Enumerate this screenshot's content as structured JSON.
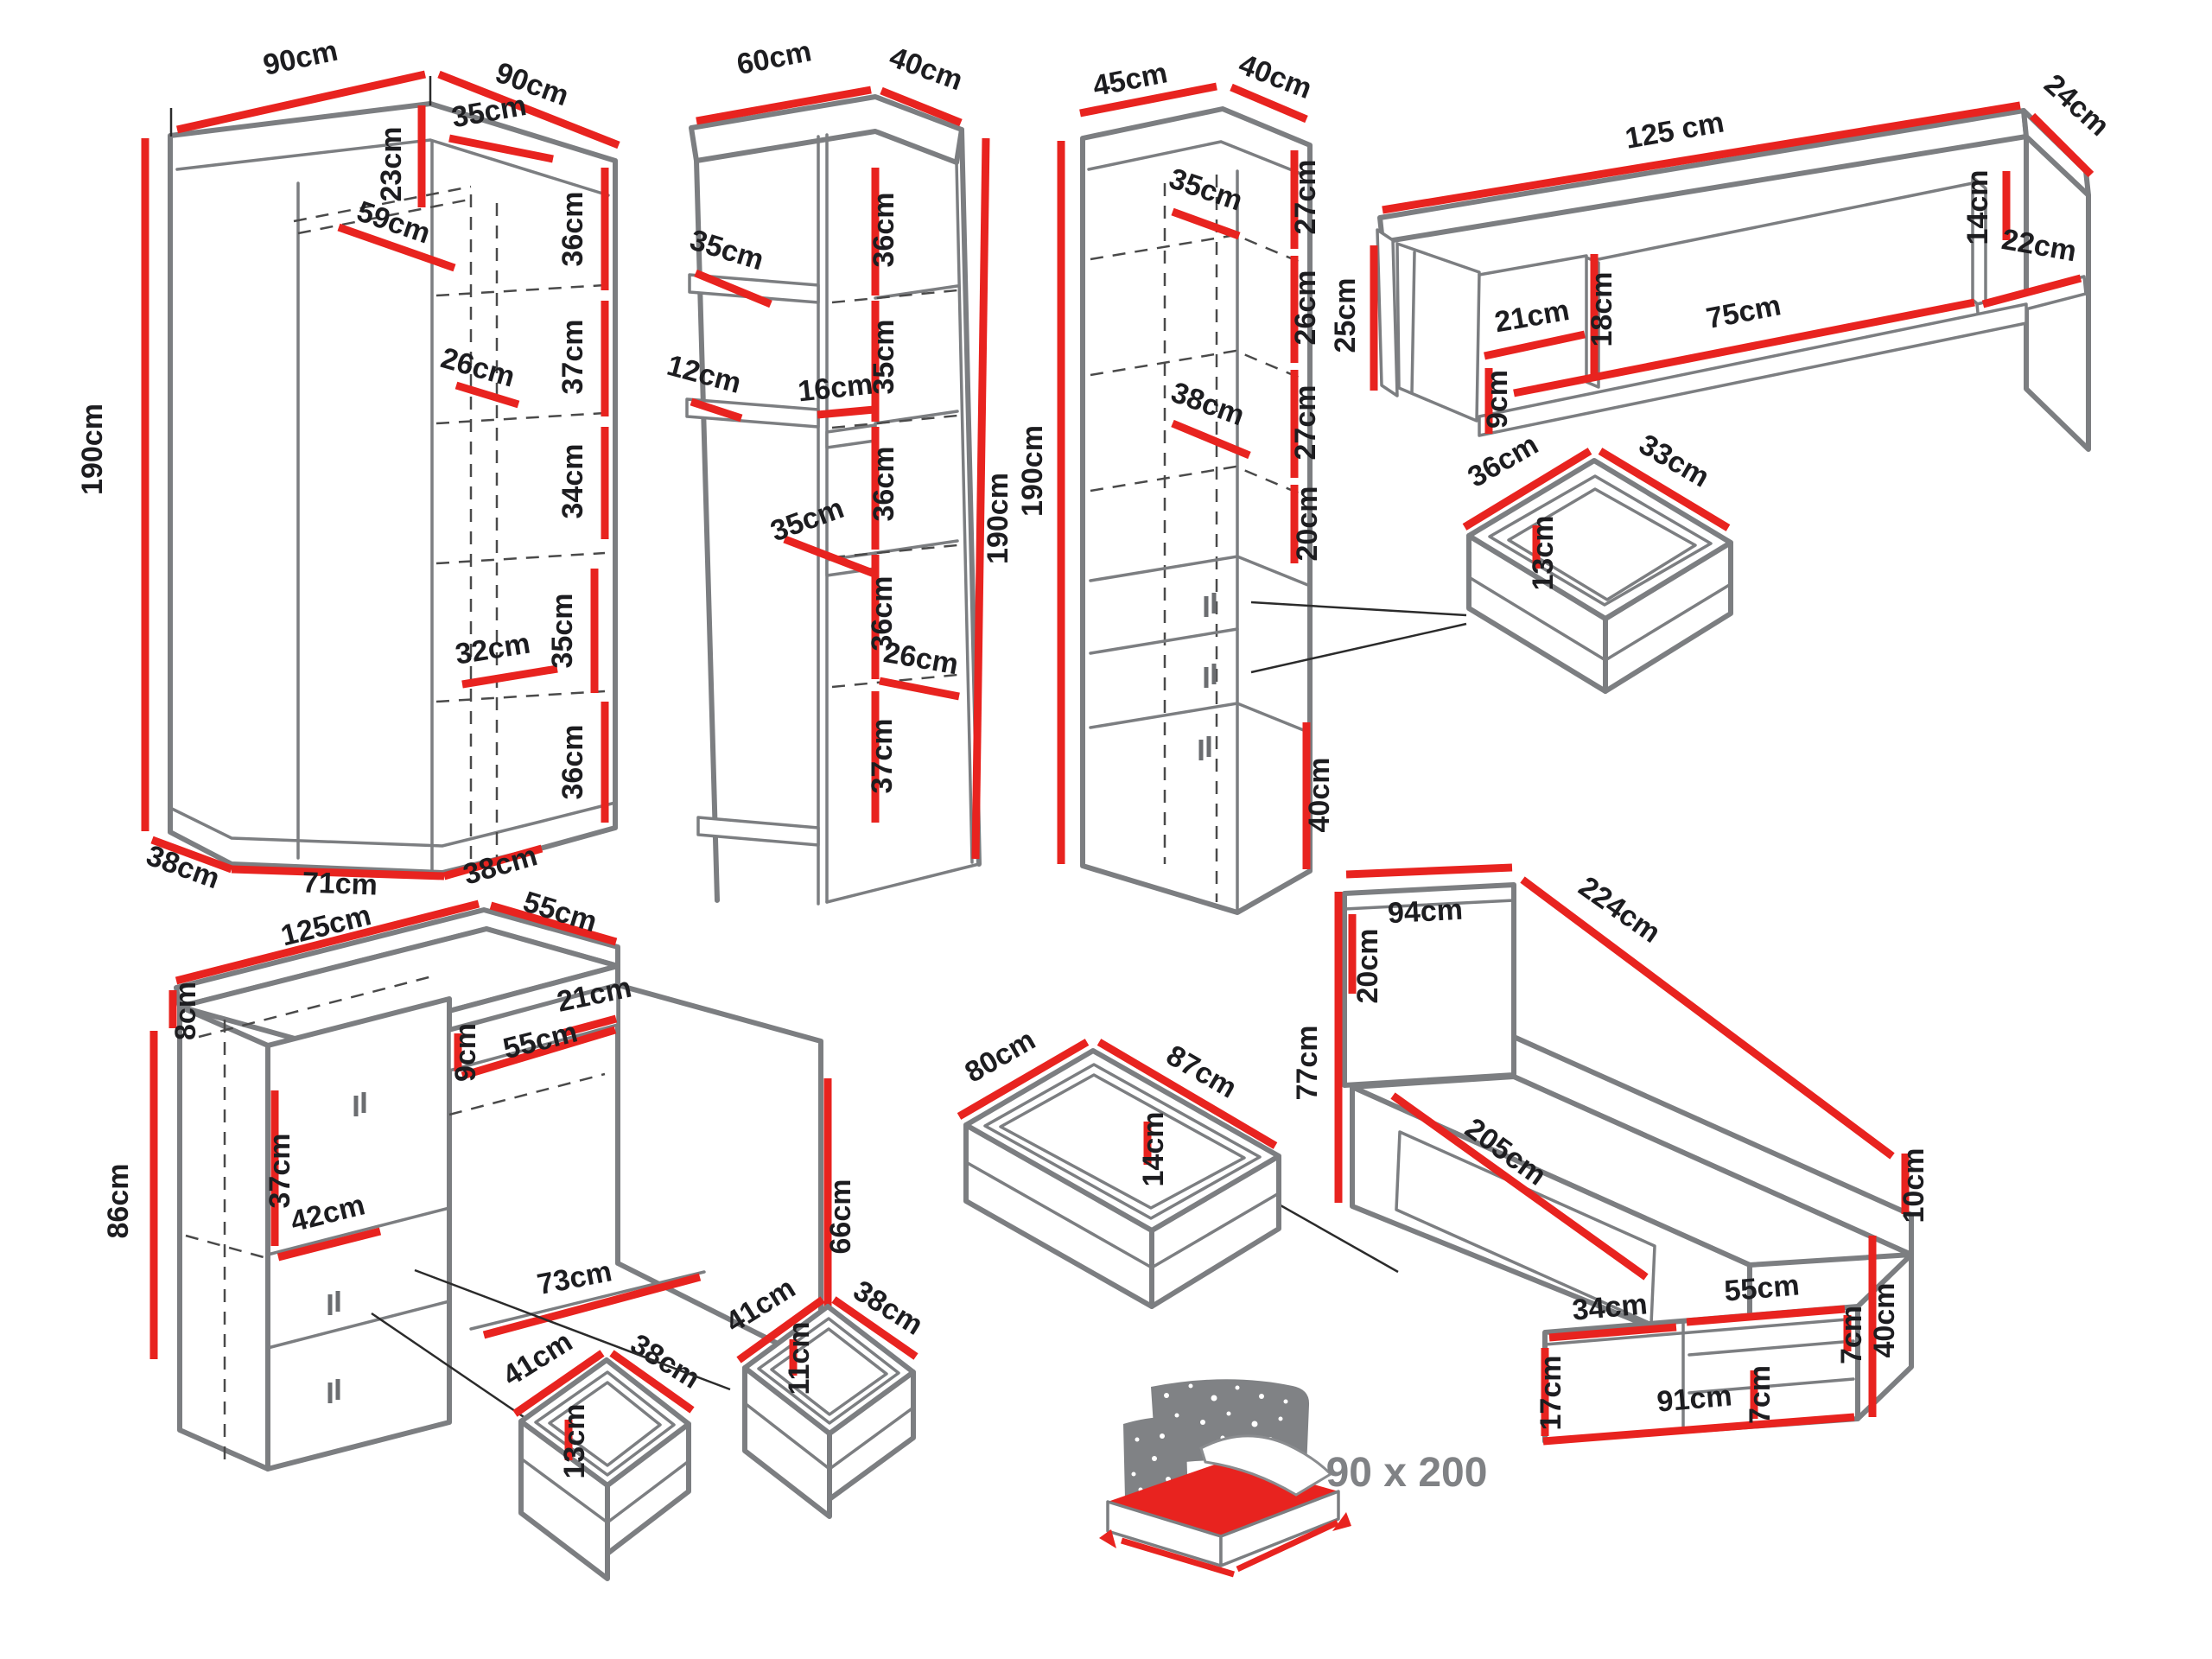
{
  "colors": {
    "dimension": "#e8231f",
    "outline": "#7c7e81",
    "label": "#1d1d20",
    "icon_gray": "#808285"
  },
  "pieces": {
    "corner_wardrobe": {
      "dims": {
        "top_left": "90cm",
        "top_right": "90cm",
        "top_inner": "35cm",
        "top_depth": "23cm",
        "shelf_diagonal": "59cm",
        "height": "190cm",
        "right_section_1": "36cm",
        "right_section_2": "37cm",
        "right_section_3": "34cm",
        "right_section_4": "35cm",
        "right_section_5": "36cm",
        "inner_width_upper": "26cm",
        "inner_width_lower": "32cm",
        "base_left": "38cm",
        "base_front": "71cm",
        "base_right": "38cm"
      }
    },
    "shelf_unit": {
      "dims": {
        "top_width": "60cm",
        "top_depth": "40cm",
        "left_shelf": "35cm",
        "left_gap": "12cm",
        "mid_gap": "16cm",
        "mid_shelf": "35cm",
        "right_section_1": "36cm",
        "right_section_2": "35cm",
        "right_section_3": "36cm",
        "right_section_4": "36cm",
        "inner_width": "26cm",
        "right_section_5": "37cm",
        "height": "190cm"
      }
    },
    "tall_cabinet": {
      "dims": {
        "top_width": "45cm",
        "top_depth": "40cm",
        "inner_top_width": "35cm",
        "right_section_1": "27cm",
        "right_section_2": "26cm",
        "right_section_3": "27cm",
        "right_section_4": "20cm",
        "inner_bottom_width": "38cm",
        "height": "190cm",
        "door_height": "40cm"
      }
    },
    "wall_shelf": {
      "dims": {
        "width": "125 cm",
        "end_depth": "24cm",
        "right_inner_height": "14cm",
        "right_shelf": "22cm",
        "left_end_height": "25cm",
        "left_compartment": "21cm",
        "left_drop": "9cm",
        "mid_height": "18cm",
        "shelf_length": "75cm"
      }
    },
    "cabinet_drawer": {
      "dims": {
        "width": "36cm",
        "depth": "33cm",
        "height": "13cm"
      }
    },
    "desk": {
      "dims": {
        "top_width": "125cm",
        "top_depth": "55cm",
        "upstand": "8cm",
        "height": "86cm",
        "niche_height": "9cm",
        "niche_width": "55cm",
        "corner_width": "21cm",
        "door_height": "37cm",
        "shelf_width": "42cm",
        "side_height": "66cm",
        "kneehole": "73cm"
      }
    },
    "desk_drawer_large": {
      "dims": {
        "width": "41cm",
        "depth": "38cm",
        "height": "13cm"
      }
    },
    "desk_drawer_small": {
      "dims": {
        "width": "41cm",
        "depth": "38cm",
        "height": "11cm"
      }
    },
    "bed_drawer": {
      "dims": {
        "width": "80cm",
        "depth": "87cm",
        "height": "14cm"
      }
    },
    "bed": {
      "dims": {
        "headboard_width": "94cm",
        "length": "224cm",
        "headboard_height": "77cm",
        "headboard_top": "20cm",
        "rail_height": "10cm",
        "side_length": "205cm",
        "foot_height": "40cm",
        "foot_left_width": "34cm",
        "foot_left_height": "17cm",
        "foot_shelf_width": "55cm",
        "foot_shelf_right": "7cm",
        "foot_shelf_mid": "7cm",
        "foot_width": "91cm"
      }
    },
    "mattress_icon": {
      "size_label": "90 x 200"
    }
  }
}
